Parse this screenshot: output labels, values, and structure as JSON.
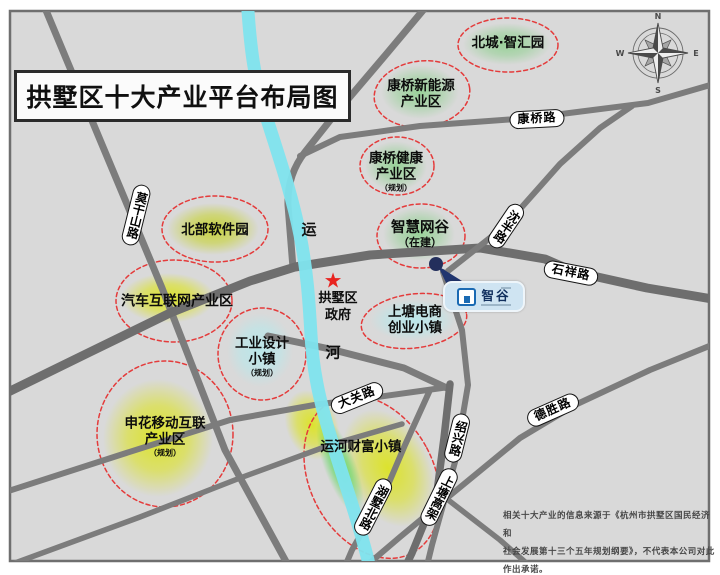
{
  "title": "拱墅区十大产业平台布局图",
  "zones": [
    {
      "id": "beicheng-zhihuiyuan",
      "lines": [
        "北城·智汇园"
      ]
    },
    {
      "id": "kangqiao-new-energy",
      "lines": [
        "康桥新能源",
        "产业区"
      ]
    },
    {
      "id": "kangqiao-health",
      "lines": [
        "康桥健康",
        "产业区"
      ],
      "note": "（规划）"
    },
    {
      "id": "zhihui-wanggu",
      "lines": [
        "智慧网谷"
      ],
      "note": "（在建）"
    },
    {
      "id": "north-software-park",
      "lines": [
        "北部软件园"
      ]
    },
    {
      "id": "auto-internet",
      "lines": [
        "汽车互联网产业区"
      ]
    },
    {
      "id": "industrial-design-town",
      "lines": [
        "工业设计",
        "小镇"
      ],
      "note": "（规划）"
    },
    {
      "id": "shangtang-ecommerce",
      "lines": [
        "上塘电商",
        "创业小镇"
      ]
    },
    {
      "id": "shenhua-mobile",
      "lines": [
        "申花移动互联",
        "产业区"
      ],
      "note": "（规划）"
    },
    {
      "id": "canal-wealth-town",
      "lines": [
        "运河财富小镇"
      ]
    }
  ],
  "roads": {
    "moganshan": "莫干山路",
    "kangqiao": "康桥路",
    "shenban": "沈半路",
    "shixiang": "石祥路",
    "daguan": "大关路",
    "desheng": "德胜路",
    "shaoxing": "绍兴路",
    "shangtang_gaojia": "上塘高架",
    "hushu_beilu": "湖墅北路"
  },
  "river": {
    "label_char_1": "运",
    "label_char_2": "河"
  },
  "landmarks": {
    "government": {
      "star_icon": "★",
      "lines": [
        "拱墅区",
        "政府"
      ]
    },
    "zhigu": {
      "label": "智谷"
    }
  },
  "compass": {
    "n": "N",
    "e": "E",
    "s": "S",
    "w": "W"
  },
  "disclaimer": {
    "lines": [
      "相关十大产业的信息来源于《杭州市拱墅区国民经济和",
      "社会发展第十三个五年规划纲要》，不代表本公司对此",
      "作出承诺。"
    ]
  },
  "colors": {
    "map_bg": "#d9d9d9",
    "road_gray": "#7c7c7c",
    "river_cyan": "#7fe4ee",
    "boundary_red": "#e43b3b",
    "blob_yellow": "#dce324",
    "blob_green": "#90d190",
    "blob_cyan": "#bfe9ec",
    "star_red": "#e8231f",
    "logo_blue": "#1a6ab3"
  }
}
